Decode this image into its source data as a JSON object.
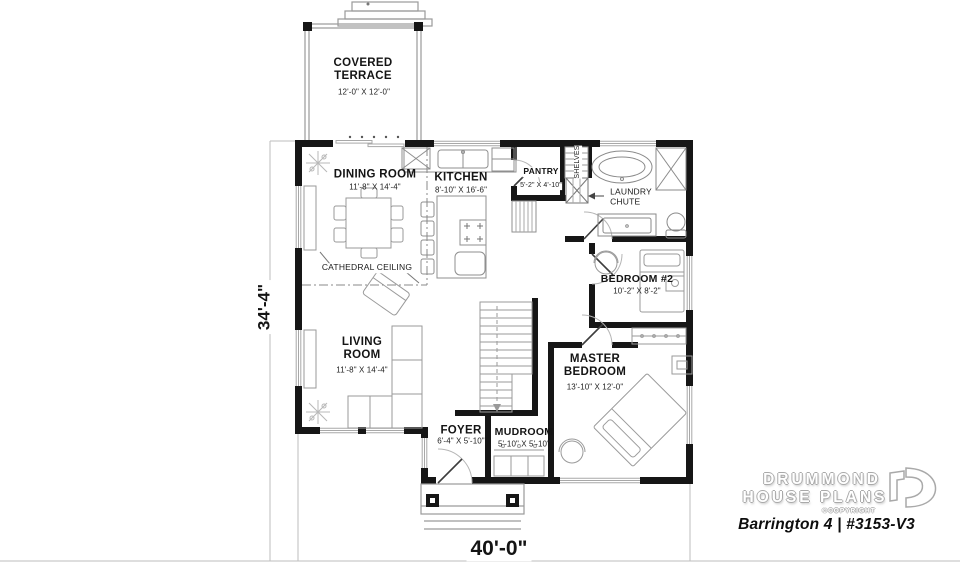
{
  "rooms": {
    "terrace": {
      "name": "COVERED\nTERRACE",
      "size": "12'-0\" X 12'-0\""
    },
    "dining": {
      "name": "DINING ROOM",
      "size": "11'-8\" X 14'-4\""
    },
    "kitchen": {
      "name": "KITCHEN",
      "size": "8'-10\" X 16'-6\""
    },
    "pantry": {
      "name": "PANTRY",
      "size": "5'-2\" X 4'-10\""
    },
    "bedroom2": {
      "name": "BEDROOM #2",
      "size": "10'-2\" X 8'-2\""
    },
    "master": {
      "name": "MASTER\nBEDROOM",
      "size": "13'-10\" X 12'-0\""
    },
    "living": {
      "name": "LIVING\nROOM",
      "size": "11'-8\" X 14'-4\""
    },
    "foyer": {
      "name": "FOYER",
      "size": "6'-4\" X 5'-10\""
    },
    "mudroom": {
      "name": "MUDROOM",
      "size": "5'-10\" X 5'-10\""
    }
  },
  "annotations": {
    "cathedral_ceiling": "CATHEDRAL CEILING",
    "shelves": "SHELVES",
    "laundry_chute": "LAUNDRY\nCHUTE"
  },
  "dimensions": {
    "overall_width": "40'-0\"",
    "overall_depth": "34'-4\""
  },
  "branding": {
    "line1": "DRUMMOND",
    "line2": "HOUSE PLANS",
    "copyright": "©COPYRIGHT",
    "plan_title": "Barrington 4 | #3153-V3"
  },
  "colors": {
    "wall": "#161616",
    "furniture_line": "#9a9a9a",
    "background": "#ffffff"
  }
}
